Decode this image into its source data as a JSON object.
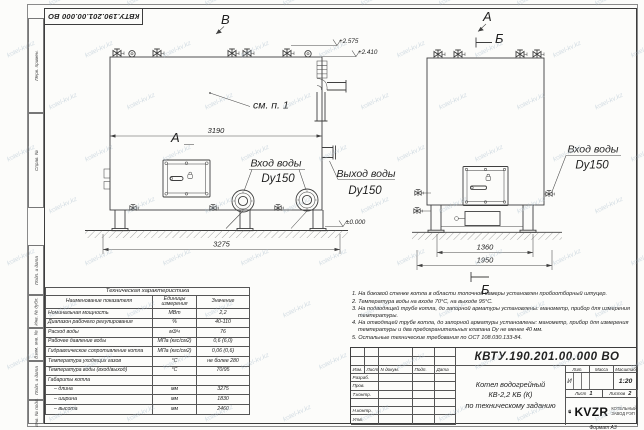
{
  "doc": {
    "stamp_number": "КВТУ.190.201.00.000 ВО",
    "format_label": "Формат  А3"
  },
  "watermark": {
    "text": "kotel-kv.kz"
  },
  "frame": {
    "left_labels": [
      "Перв. примен.",
      "Справ. №",
      "Подп. и дата",
      "Инв. № дубл.",
      "Взам. инв. №",
      "Подп. и дата",
      "Инв. № подл."
    ]
  },
  "drawing": {
    "front": {
      "label_top": "В",
      "label_left": "А",
      "callout": "см. п. 1",
      "dim_width": "3190",
      "dim_length": "3275",
      "inlet_line1": "Вход воды",
      "inlet_line2": "Dy150",
      "outlet_line1": "Выход воды",
      "outlet_line2": "Dy150",
      "elev_top": "+2.575",
      "elev_mid": "+2.410",
      "elev_zero": "±0.000"
    },
    "side": {
      "label_top_a": "А",
      "label_top_b": "Б",
      "label_bottom_b": "Б",
      "dim_inner": "1360",
      "dim_outer": "1950",
      "inlet_line1": "Вход воды",
      "inlet_line2": "Dy150"
    }
  },
  "spec_table": {
    "title": "Техническая характеристика",
    "headers": [
      "Наименование показателя",
      "Единицы измерения",
      "Значение"
    ],
    "rows": [
      [
        "Номинальная мощность",
        "МВт",
        "2,2"
      ],
      [
        "Диапазон рабочего регулирования",
        "%",
        "40-110"
      ],
      [
        "Расход воды",
        "м3/ч",
        "76"
      ],
      [
        "Рабочее давление воды",
        "МПа (кгс/см2)",
        "0,6 (6,0)"
      ],
      [
        "Гидравлическое сопротивление котла",
        "МПа (кгс/см2)",
        "0,06 (0,6)"
      ],
      [
        "Температура уходящих газов",
        "°С",
        "не более 280"
      ],
      [
        "Температура воды (вход/выход)",
        "°С",
        "70/95"
      ],
      [
        "Габариты котла",
        "",
        ""
      ],
      [
        "– длина",
        "мм",
        "3275"
      ],
      [
        "– ширина",
        "мм",
        "1830"
      ],
      [
        "– высота",
        "мм",
        "2460"
      ]
    ]
  },
  "notes": {
    "items": [
      "1.  На боковой стенке котла в области топочной камеры установлен пробоотборный штуцер.",
      "2.  Температура воды на входе 70°С, на выходе 95°С.",
      "3.  На подводящей трубе котла, до запорной арматуры установлены: манометр, прибор для измерения температуры.",
      "4.  На отводящей трубе котла, до запорной арматуры установлены: манометр, прибор для измерения температуры и два предохранительных клапана Dу не менее 40 мм.",
      "5.  Остальные технические требования по ОСТ 108.030.133-84."
    ]
  },
  "title_block": {
    "doc_number": "КВТУ.190.201.00.000  ВО",
    "name_line1": "Котел водогрейный",
    "name_line2": "КВ-2,2 КБ (К)",
    "name_line3": "по техническому заданию",
    "header_cells": [
      "Изм.",
      "Лист",
      "N докум.",
      "Подп.",
      "Дата"
    ],
    "sig_rows": [
      "Разраб.",
      "Пров.",
      "Т.контр.",
      "",
      "Н.контр.",
      "Утв."
    ],
    "lit_label": "Лит.",
    "mass_label": "Масса",
    "scale_label": "Масштаб",
    "lit_value": "И",
    "scale_value": "1:20",
    "sheet_label": "Лист",
    "sheet_value": "1",
    "sheets_label": "Листов",
    "sheets_value": "2",
    "logo_text": "KVZR",
    "org_line1": "КОТЕЛЬНЫЙ",
    "org_line2": "ЗАВОД РЭП"
  }
}
